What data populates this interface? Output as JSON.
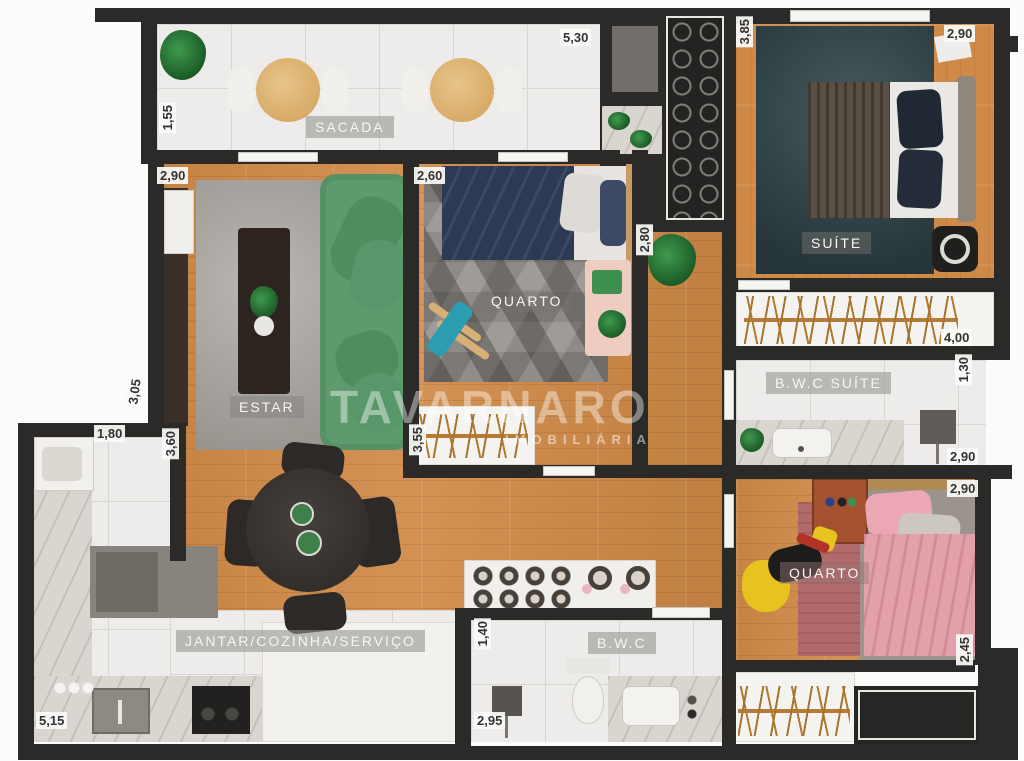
{
  "watermark": {
    "name": "TAVARNARO",
    "tagline": "IMOBILIÁRIA"
  },
  "rooms": {
    "sacada": "SACADA",
    "estar": "ESTAR",
    "quarto1": "QUARTO",
    "suite": "SUÍTE",
    "bwc_suite": "B.W.C SUÍTE",
    "quarto2": "QUARTO",
    "jantar": "JANTAR/COZINHA/SERVIÇO",
    "bwc": "B.W.C"
  },
  "dimensions": {
    "sacada_width": "5,30",
    "sacada_depth": "1,55",
    "estar_width": "2,90",
    "estar_depth": "3,05",
    "quarto1_width": "2,60",
    "quarto1_closet": "3,55",
    "hall_width": "2,80",
    "entry_depth": "3,85",
    "suite_width": "2,90",
    "closet_length": "4,00",
    "bwc_suite_depth": "1,30",
    "bwc_suite_width": "2,90",
    "quarto2_width": "2,90",
    "quarto2_depth": "2,45",
    "kitchen_top": "1,80",
    "kitchen_depth": "3,60",
    "kitchen_width": "5,15",
    "bwc_depth": "1,40",
    "bwc_width": "2,95"
  },
  "colors": {
    "wall": "#2b2a28",
    "wood": "#d08a47",
    "tile": "#edecea",
    "marble": "#d9d5cf",
    "sofa-green": "#5d9b6c",
    "suite-rug": "#32474c",
    "estar-rug": "#a39f99",
    "quarto1-rug": "#8e8a85",
    "quarto2-rug": "#b2696b",
    "bed-navy": "#2c3a55",
    "bed-pink": "#e2a0ab"
  }
}
